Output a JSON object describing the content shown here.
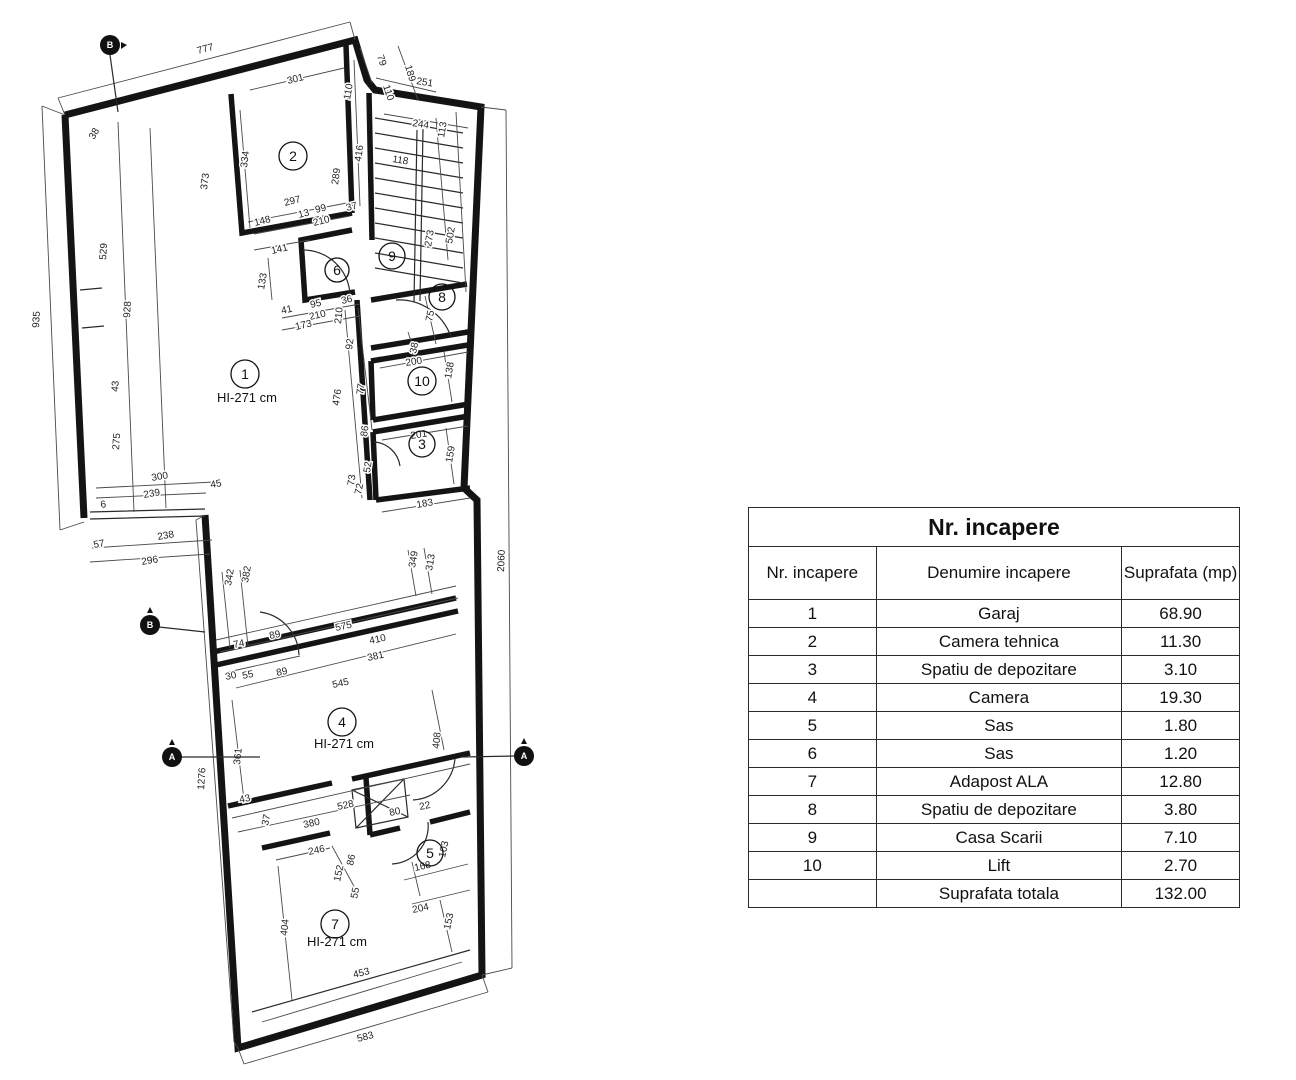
{
  "plan": {
    "hi_label": "HI-271 cm",
    "rooms": [
      {
        "n": "1"
      },
      {
        "n": "2"
      },
      {
        "n": "3"
      },
      {
        "n": "4"
      },
      {
        "n": "5"
      },
      {
        "n": "6"
      },
      {
        "n": "7"
      },
      {
        "n": "8"
      },
      {
        "n": "9"
      },
      {
        "n": "10"
      }
    ],
    "markers": [
      "B",
      "B",
      "A",
      "A"
    ],
    "dims": [
      "777",
      "79",
      "189",
      "110",
      "251",
      "301",
      "110",
      "334",
      "416",
      "373",
      "244",
      "113",
      "118",
      "289",
      "297",
      "148",
      "13",
      "99",
      "210",
      "37",
      "141",
      "133",
      "273",
      "502",
      "41",
      "95",
      "36",
      "210",
      "173",
      "210",
      "75",
      "38",
      "935",
      "928",
      "529",
      "43",
      "275",
      "92",
      "77",
      "476",
      "86",
      "52",
      "73",
      "200",
      "138",
      "201",
      "159",
      "183",
      "300",
      "239",
      "45",
      "6",
      "57",
      "238",
      "296",
      "2060",
      "342",
      "382",
      "349",
      "313",
      "575",
      "410",
      "74",
      "89",
      "30",
      "55",
      "89",
      "381",
      "545",
      "361",
      "408",
      "1276",
      "528",
      "380",
      "80",
      "22",
      "43",
      "37",
      "246",
      "86",
      "152",
      "55",
      "168",
      "103",
      "204",
      "153",
      "404",
      "453",
      "583",
      "72",
      "38"
    ]
  },
  "table": {
    "title": "Nr. incapere",
    "headers": [
      "Nr. incapere",
      "Denumire incapere",
      "Suprafata (mp)"
    ],
    "rows": [
      {
        "nr": "1",
        "name": "Garaj",
        "area": "68.90"
      },
      {
        "nr": "2",
        "name": "Camera tehnica",
        "area": "11.30"
      },
      {
        "nr": "3",
        "name": "Spatiu de depozitare",
        "area": "3.10"
      },
      {
        "nr": "4",
        "name": "Camera",
        "area": "19.30"
      },
      {
        "nr": "5",
        "name": "Sas",
        "area": "1.80"
      },
      {
        "nr": "6",
        "name": "Sas",
        "area": "1.20"
      },
      {
        "nr": "7",
        "name": "Adapost ALA",
        "area": "12.80"
      },
      {
        "nr": "8",
        "name": "Spatiu de depozitare",
        "area": "3.80"
      },
      {
        "nr": "9",
        "name": "Casa Scarii",
        "area": "7.10"
      },
      {
        "nr": "10",
        "name": "Lift",
        "area": "2.70"
      },
      {
        "nr": "",
        "name": "Suprafata totala",
        "area": "132.00"
      }
    ]
  }
}
